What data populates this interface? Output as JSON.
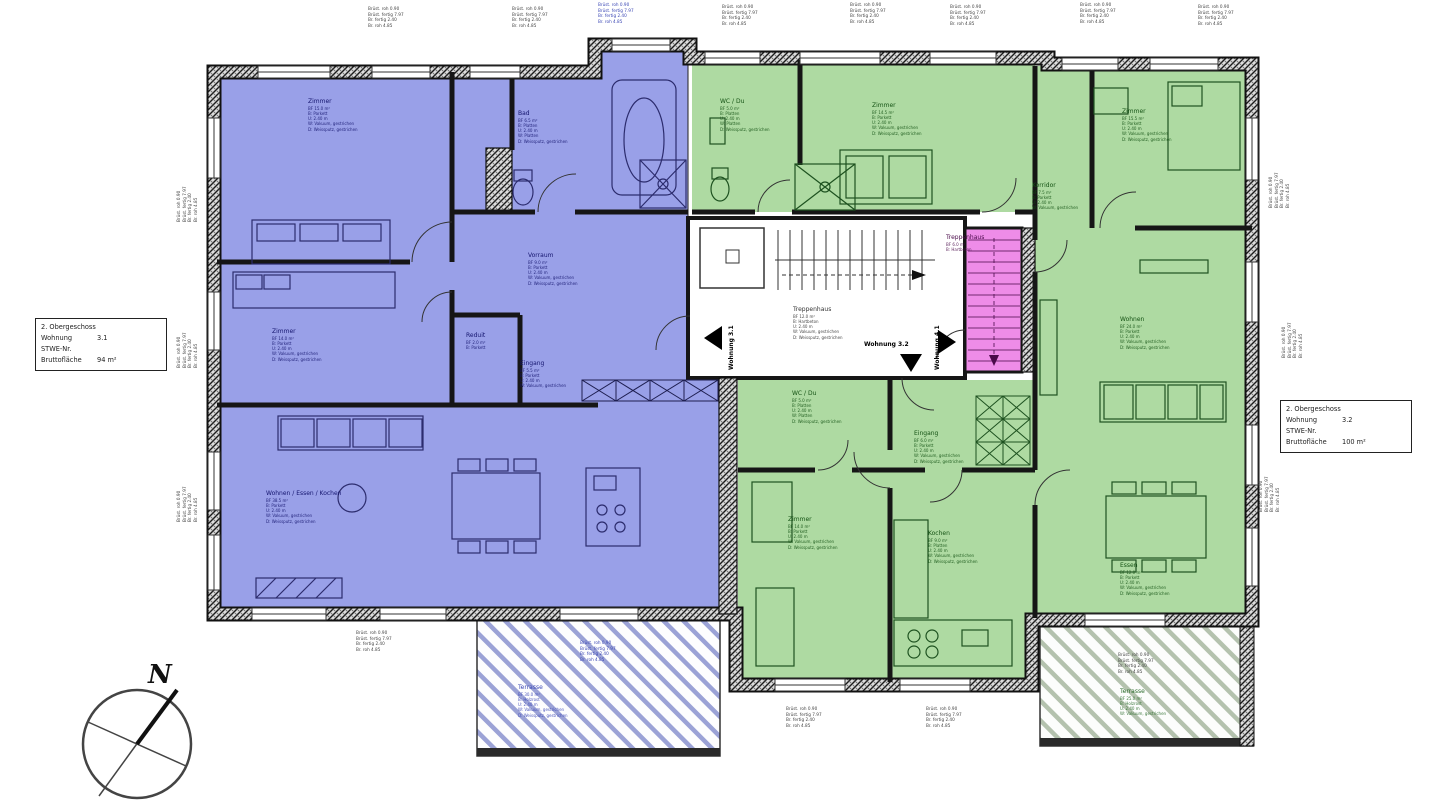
{
  "title_boxes": {
    "left": {
      "floor": "2. Obergeschoss",
      "wohnung_label": "Wohnung",
      "wohnung_value": "3.1",
      "stwe_label": "STWE-Nr.",
      "area_label": "Bruttofläche",
      "area_value": "94 m²"
    },
    "right": {
      "floor": "2. Obergeschoss",
      "wohnung_label": "Wohnung",
      "wohnung_value": "3.2",
      "stwe_label": "STWE-Nr.",
      "area_label": "Bruttofläche",
      "area_value": "100 m²"
    }
  },
  "compass": {
    "north_label": "N"
  },
  "entrance_markers": [
    {
      "label": "Wohnung 3.1"
    },
    {
      "label": "Wohnung 3.2"
    },
    {
      "label": "Wohnung 4.1"
    }
  ],
  "colors": {
    "apartment_blue": "#99a0e8",
    "apartment_green": "#aedaa2",
    "stair_pink": "#ee8ce8",
    "text_blue": "#14146e",
    "text_green": "#145214"
  },
  "dim_stack_lines": [
    "Brüst. roh 0.90",
    "Brüst. fertig 7.97",
    "Br. fertig 2.40",
    "Br. roh 4.85"
  ],
  "dim_stacks": [
    {
      "x": 368,
      "y": 6,
      "rot": false
    },
    {
      "x": 512,
      "y": 6,
      "rot": false
    },
    {
      "x": 598,
      "y": 2,
      "rot": false,
      "color": "#3a46b4"
    },
    {
      "x": 722,
      "y": 4,
      "rot": false
    },
    {
      "x": 850,
      "y": 2,
      "rot": false
    },
    {
      "x": 950,
      "y": 4,
      "rot": false
    },
    {
      "x": 1080,
      "y": 2,
      "rot": false
    },
    {
      "x": 1198,
      "y": 4,
      "rot": false
    },
    {
      "x": 176,
      "y": 222,
      "rot": true
    },
    {
      "x": 176,
      "y": 368,
      "rot": true
    },
    {
      "x": 176,
      "y": 522,
      "rot": true
    },
    {
      "x": 1268,
      "y": 208,
      "rot": true
    },
    {
      "x": 1281,
      "y": 358,
      "rot": true
    },
    {
      "x": 1258,
      "y": 512,
      "rot": true
    },
    {
      "x": 356,
      "y": 630,
      "rot": false
    },
    {
      "x": 580,
      "y": 640,
      "rot": false,
      "color": "#3a46b4"
    },
    {
      "x": 786,
      "y": 706,
      "rot": false
    },
    {
      "x": 926,
      "y": 706,
      "rot": false
    },
    {
      "x": 1118,
      "y": 652,
      "rot": false
    }
  ],
  "rooms": [
    {
      "name": "Zimmer",
      "x": 308,
      "y": 98,
      "color": "#14146e",
      "lines": [
        "BF 15.0 m²",
        "B: Parkett",
        "U: 2.40 m",
        "W: Vakuum, gestrichen",
        "D: Weissputz, gestrichen"
      ]
    },
    {
      "name": "Bad",
      "x": 518,
      "y": 110,
      "color": "#14146e",
      "lines": [
        "BF 6.5 m²",
        "B: Platten",
        "U: 2.40 m",
        "W: Platten",
        "D: Weissputz, gestrichen"
      ]
    },
    {
      "name": "Vorraum",
      "x": 528,
      "y": 252,
      "color": "#14146e",
      "lines": [
        "BF 9.0 m²",
        "B: Parkett",
        "U: 2.40 m",
        "W: Vakuum, gestrichen",
        "D: Weissputz, gestrichen"
      ]
    },
    {
      "name": "Zimmer",
      "x": 272,
      "y": 328,
      "color": "#14146e",
      "lines": [
        "BF 14.0 m²",
        "B: Parkett",
        "U: 2.40 m",
        "W: Vakuum, gestrichen",
        "D: Weissputz, gestrichen"
      ]
    },
    {
      "name": "Reduit",
      "x": 466,
      "y": 332,
      "color": "#14146e",
      "lines": [
        "BF 2.0 m²",
        "B: Parkett"
      ]
    },
    {
      "name": "Eingang",
      "x": 520,
      "y": 360,
      "color": "#14146e",
      "lines": [
        "BF 5.5 m²",
        "B: Parkett",
        "U: 2.40 m",
        "W: Vakuum, gestrichen"
      ]
    },
    {
      "name": "Wohnen / Essen / Kochen",
      "x": 266,
      "y": 490,
      "color": "#14146e",
      "lines": [
        "BF 38.5 m²",
        "B: Parkett",
        "U: 2.40 m",
        "W: Vakuum, gestrichen",
        "D: Weissputz, gestrichen"
      ]
    },
    {
      "name": "Terrasse",
      "x": 518,
      "y": 684,
      "color": "#3a46b4",
      "lines": [
        "BF 30.0 m²",
        "B: Holzrost",
        "U: 2.40 m",
        "W: Vakuum, gestrichen",
        "D: Weissputz, gestrichen"
      ]
    },
    {
      "name": "Treppenhaus",
      "x": 793,
      "y": 306,
      "color": "#333333",
      "lines": [
        "BF 12.0 m²",
        "B: Hartbeton",
        "U: 2.40 m",
        "W: Vakuum, gestrichen",
        "D: Weissputz, gestrichen"
      ]
    },
    {
      "name": "Treppenhaus",
      "x": 946,
      "y": 234,
      "color": "#4a0a4a",
      "lines": [
        "BF 6.0 m²",
        "B: Hartbeton"
      ]
    },
    {
      "name": "WC / Du",
      "x": 720,
      "y": 98,
      "color": "#145214",
      "lines": [
        "BF 5.0 m²",
        "B: Platten",
        "U: 2.40 m",
        "W: Platten",
        "D: Weissputz, gestrichen"
      ]
    },
    {
      "name": "Zimmer",
      "x": 872,
      "y": 102,
      "color": "#145214",
      "lines": [
        "BF 14.5 m²",
        "B: Parkett",
        "U: 2.40 m",
        "W: Vakuum, gestrichen",
        "D: Weissputz, gestrichen"
      ]
    },
    {
      "name": "Zimmer",
      "x": 1122,
      "y": 108,
      "color": "#145214",
      "lines": [
        "BF 15.5 m²",
        "B: Parkett",
        "U: 2.40 m",
        "W: Vakuum, gestrichen",
        "D: Weissputz, gestrichen"
      ]
    },
    {
      "name": "Korridor",
      "x": 1032,
      "y": 182,
      "color": "#145214",
      "lines": [
        "BF 7.5 m²",
        "B: Parkett",
        "U: 2.40 m",
        "W: Vakuum, gestrichen"
      ]
    },
    {
      "name": "Wohnen",
      "x": 1120,
      "y": 316,
      "color": "#145214",
      "lines": [
        "BF 24.0 m²",
        "B: Parkett",
        "U: 2.40 m",
        "W: Vakuum, gestrichen",
        "D: Weissputz, gestrichen"
      ]
    },
    {
      "name": "Essen",
      "x": 1120,
      "y": 562,
      "color": "#145214",
      "lines": [
        "BF 12.0 m²",
        "B: Parkett",
        "U: 2.40 m",
        "W: Vakuum, gestrichen",
        "D: Weissputz, gestrichen"
      ]
    },
    {
      "name": "Eingang",
      "x": 914,
      "y": 430,
      "color": "#145214",
      "lines": [
        "BF 6.0 m²",
        "B: Parkett",
        "U: 2.40 m",
        "W: Vakuum, gestrichen",
        "D: Weissputz, gestrichen"
      ]
    },
    {
      "name": "WC / Du",
      "x": 792,
      "y": 390,
      "color": "#145214",
      "lines": [
        "BF 5.0 m²",
        "B: Platten",
        "U: 2.40 m",
        "W: Platten",
        "D: Weissputz, gestrichen"
      ]
    },
    {
      "name": "Zimmer",
      "x": 788,
      "y": 516,
      "color": "#145214",
      "lines": [
        "BF 14.0 m²",
        "B: Parkett",
        "U: 2.40 m",
        "W: Vakuum, gestrichen",
        "D: Weissputz, gestrichen"
      ]
    },
    {
      "name": "Kochen",
      "x": 928,
      "y": 530,
      "color": "#145214",
      "lines": [
        "BF 9.0 m²",
        "B: Platten",
        "U: 2.40 m",
        "W: Vakuum, gestrichen",
        "D: Weissputz, gestrichen"
      ]
    },
    {
      "name": "Terrasse",
      "x": 1120,
      "y": 688,
      "color": "#2a6b2a",
      "lines": [
        "BF 25.0 m²",
        "B: Holzrost",
        "U: 2.40 m",
        "W: Vakuum, gestrichen"
      ]
    }
  ]
}
